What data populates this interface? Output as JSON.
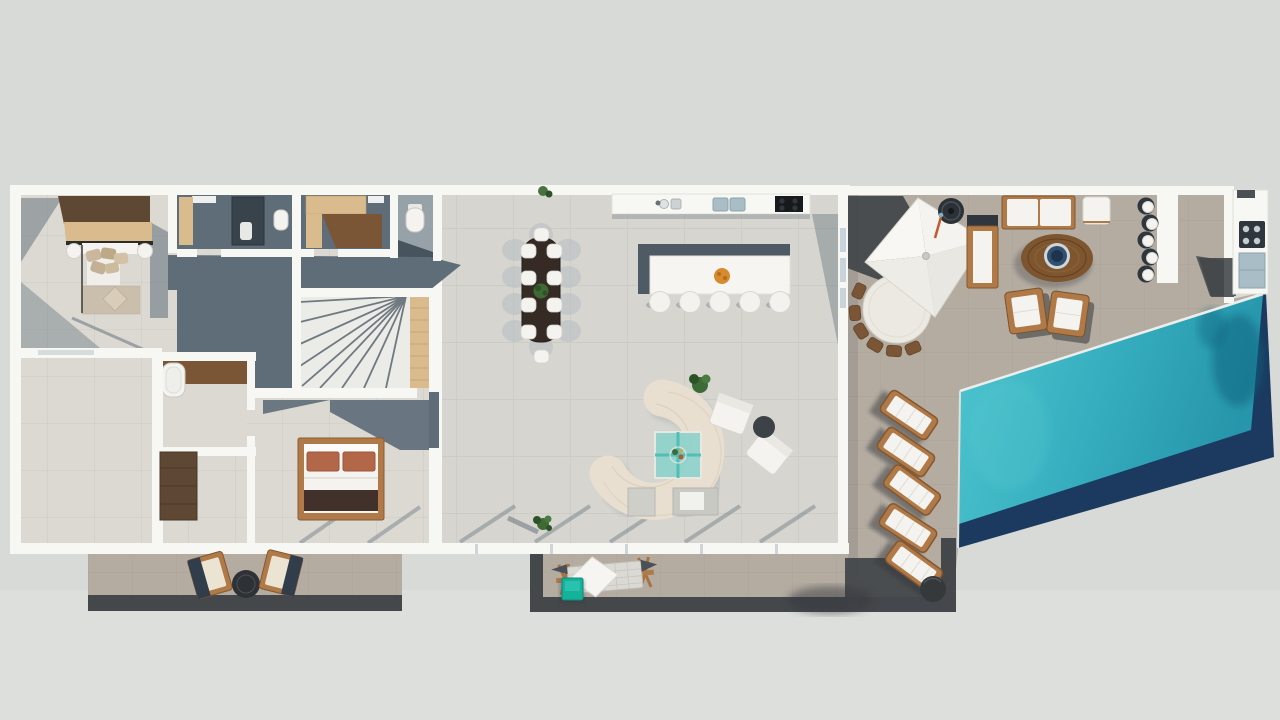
{
  "view": {
    "description": "top-down 3D architectural floor plan render of a single-storey villa with outdoor terrace and swimming pool",
    "width_px": 1280,
    "height_px": 720,
    "visible_text": ""
  },
  "palette": {
    "bg": "#d7dad6",
    "bgLight": "#dee1dd",
    "wall": "#f7f7f4",
    "tile": "#d6d5cf",
    "tileLine": "#c3c3bc",
    "tile2": "#dbd9d2",
    "tile2Line": "#c9c7bf",
    "slate": "#5f6d78",
    "slateDark": "#47545e",
    "slateSoft": "#97a1a8",
    "charcoal": "#44484b",
    "charcoalDark": "#35393c",
    "taupe": "#b4aca1",
    "poolTealLight": "#4fc6cf",
    "poolTeal": "#2ba4b7",
    "poolNavy": "#1c3a60",
    "woodLight": "#d9bb8e",
    "woodMid": "#b07a48",
    "woodDark": "#7b5636",
    "walnut": "#5e4733",
    "espresso": "#352b24",
    "whiteF": "#f4f3ef",
    "cream": "#ece4d2",
    "rust": "#b36749",
    "throw": "#42312a",
    "tealCube": "#14b19b",
    "tealGlass": "#8fd2cc",
    "tealGlassLine": "#49bdb4",
    "steel": "#a9bdc6",
    "steelDark": "#2f363d",
    "orange": "#d88a2e",
    "green": "#3e6a35",
    "greenDark": "#2c5227"
  },
  "inventory": {
    "indoor": {
      "bedrooms": 2,
      "bathrooms": 1,
      "powder_rooms": 1,
      "closet_rooms": 2,
      "staircase": 1,
      "dining_seats": 10,
      "kitchen_island_stools": 5,
      "curved_sofa": 1,
      "armchairs": 2,
      "coffee_table": 1,
      "bathtub": 1,
      "wardrobes": 2
    },
    "outdoor": {
      "pergola": 1,
      "pergola_dining_chairs": 6,
      "outdoor_sofa": 1,
      "chaise": 1,
      "ottoman": 1,
      "fire_pit_table": 1,
      "outdoor_armchairs": 2,
      "bar_stools": 5,
      "bar_counter": 1,
      "outdoor_kitchen_grill": 1,
      "sun_loungers": 5,
      "side_tables": 3,
      "patio_lounge_chairs": 2,
      "swing_daybed": 1,
      "teal_pouf_cube": 1,
      "swimming_pool": 1
    }
  }
}
